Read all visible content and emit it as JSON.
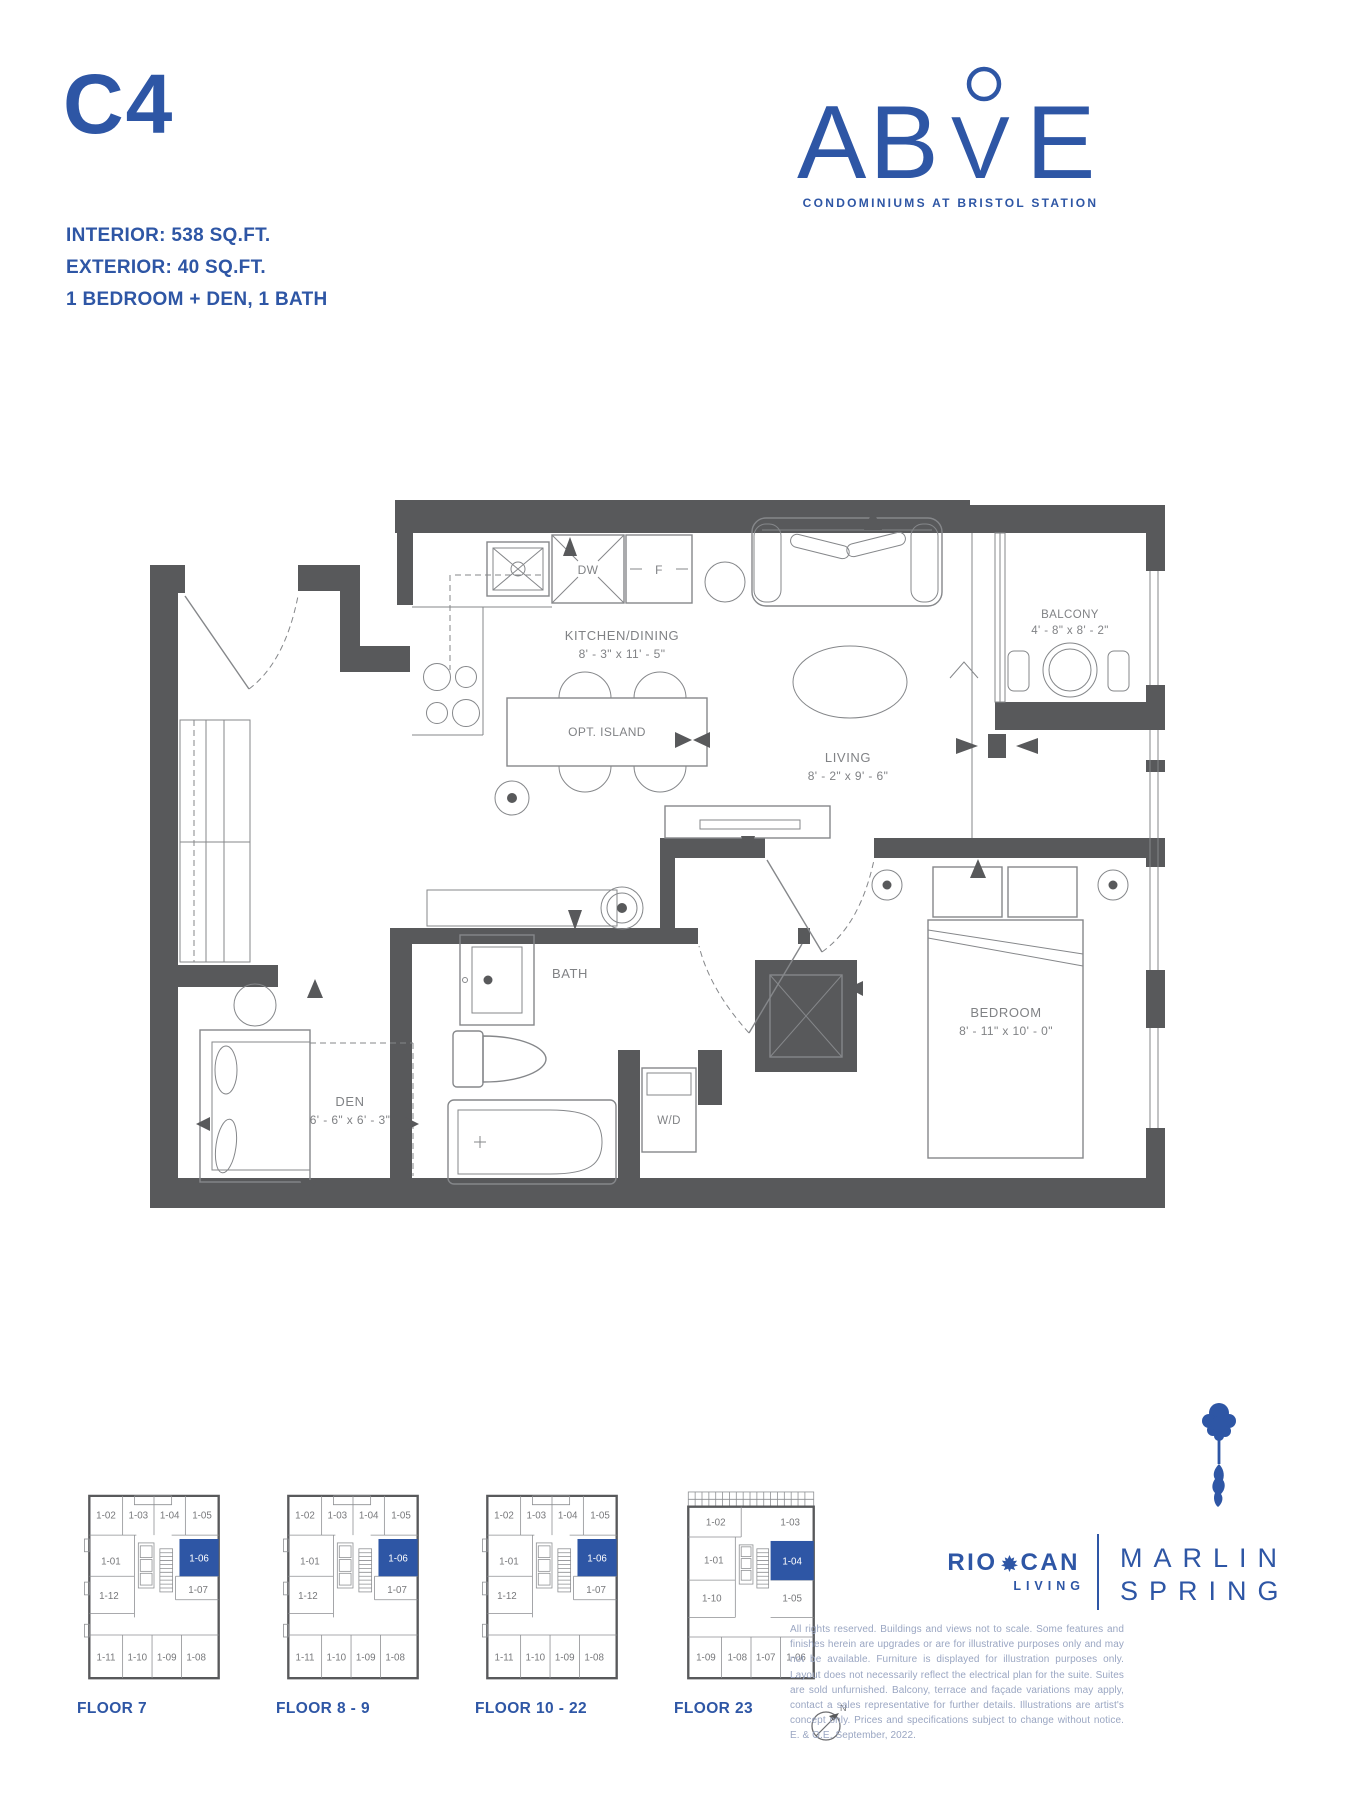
{
  "header": {
    "unit_code": "C4",
    "specs": [
      "INTERIOR: 538 SQ.FT.",
      "EXTERIOR: 40 SQ.FT.",
      "1 BEDROOM + DEN, 1 BATH"
    ]
  },
  "brand": {
    "logo_left": "AB",
    "logo_mid": "V",
    "logo_right": "E",
    "tagline": "CONDOMINIUMS AT BRISTOL STATION"
  },
  "floorplan": {
    "kitchen": {
      "name": "KITCHEN/DINING",
      "dims": "8' - 3\" x 11' - 5\""
    },
    "living": {
      "name": "LIVING",
      "dims": "8' - 2\" x 9' - 6\""
    },
    "balcony": {
      "name": "BALCONY",
      "dims": "4' - 8\" x 8' - 2\""
    },
    "bedroom": {
      "name": "BEDROOM",
      "dims": "8' - 11\" x 10' - 0\""
    },
    "den": {
      "name": "DEN",
      "dims": "6' - 6\" x 6' - 3\""
    },
    "bath": {
      "name": "BATH"
    },
    "labels": {
      "dishwasher": "DW",
      "fridge": "F",
      "island": "OPT. ISLAND",
      "washer_dryer": "W/D"
    }
  },
  "keyplans": {
    "compass_north": "N",
    "plates": [
      {
        "label": "FLOOR 7",
        "highlighted_unit": "1-06",
        "units": [
          "1-02",
          "1-03",
          "1-04",
          "1-05",
          "1-01",
          "1-06",
          "1-07",
          "1-12",
          "1-11",
          "1-10",
          "1-09",
          "1-08"
        ]
      },
      {
        "label": "FLOOR 8 - 9",
        "highlighted_unit": "1-06",
        "units": [
          "1-02",
          "1-03",
          "1-04",
          "1-05",
          "1-01",
          "1-06",
          "1-07",
          "1-12",
          "1-11",
          "1-10",
          "1-09",
          "1-08"
        ]
      },
      {
        "label": "FLOOR 10 - 22",
        "highlighted_unit": "1-06",
        "units": [
          "1-02",
          "1-03",
          "1-04",
          "1-05",
          "1-01",
          "1-06",
          "1-07",
          "1-12",
          "1-11",
          "1-10",
          "1-09",
          "1-08"
        ]
      },
      {
        "label": "FLOOR 23",
        "highlighted_unit": "1-04",
        "units": [
          "1-02",
          "1-03",
          "1-01",
          "1-04",
          "1-10",
          "1-05",
          "1-09",
          "1-08",
          "1-07",
          "1-06"
        ]
      }
    ]
  },
  "footer": {
    "riocan": {
      "word_left": "RIO",
      "word_right": "CAN",
      "sub": "LIVING"
    },
    "marlin": {
      "line1": "MARLIN",
      "line2": "SPRING"
    },
    "disclaimer": "All rights reserved. Buildings and views not to scale. Some features and finishes herein are upgrades or are for illustrative purposes only and may not be available. Furniture is displayed for illustration purposes only. Layout does not necessarily reflect the electrical plan for the suite. Suites are sold unfurnished. Balcony, terrace and façade variations may apply, contact a sales representative for further details. Illustrations are artist's concept only. Prices and specifications subject to change without notice. E. & O.E. September, 2022."
  },
  "colors": {
    "accent": "#2e56a5",
    "wall": "#58595b",
    "plan_line": "#85878a",
    "plan_label": "#808285",
    "disclaimer_text": "#9aa6c2"
  }
}
